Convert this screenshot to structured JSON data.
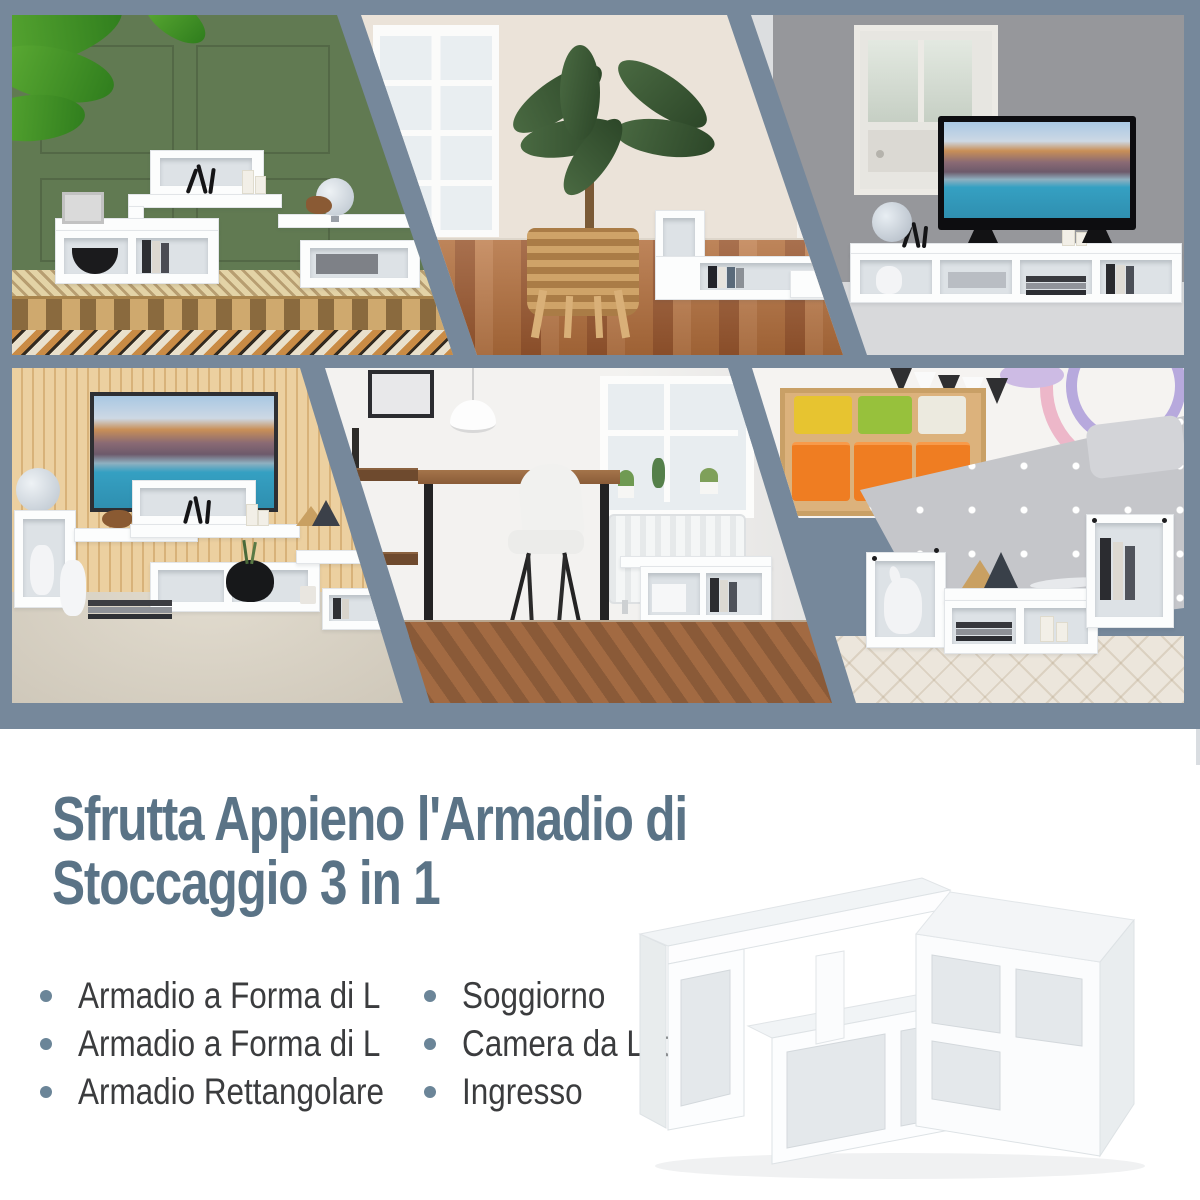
{
  "collage": {
    "frame_color": "#76889b",
    "photos": [
      {
        "label": "green-living-room-with-modular-shelf"
      },
      {
        "label": "beige-room-palm-plant-wood-floor"
      },
      {
        "label": "gray-living-room-tv-stand"
      },
      {
        "label": "wood-slat-wall-tv-console"
      },
      {
        "label": "home-office-desk-bookshelf"
      },
      {
        "label": "kids-bedroom-storage-shelf"
      }
    ]
  },
  "content": {
    "heading_line1": "Sfrutta Appieno l'Armadio di",
    "heading_line2": "Stoccaggio 3 in 1",
    "heading_color": "#5a7386",
    "text_color": "#3b3c3e",
    "bullet_dot_color": "#6b8598",
    "bullets_left": [
      "Armadio a Forma di L",
      "Armadio a Forma di L",
      "Armadio Rettangolare"
    ],
    "bullets_right": [
      "Soggiorno",
      "Camera da Letto",
      "Ingresso"
    ],
    "product_image": "white-3-in-1-modular-cube-shelf"
  }
}
